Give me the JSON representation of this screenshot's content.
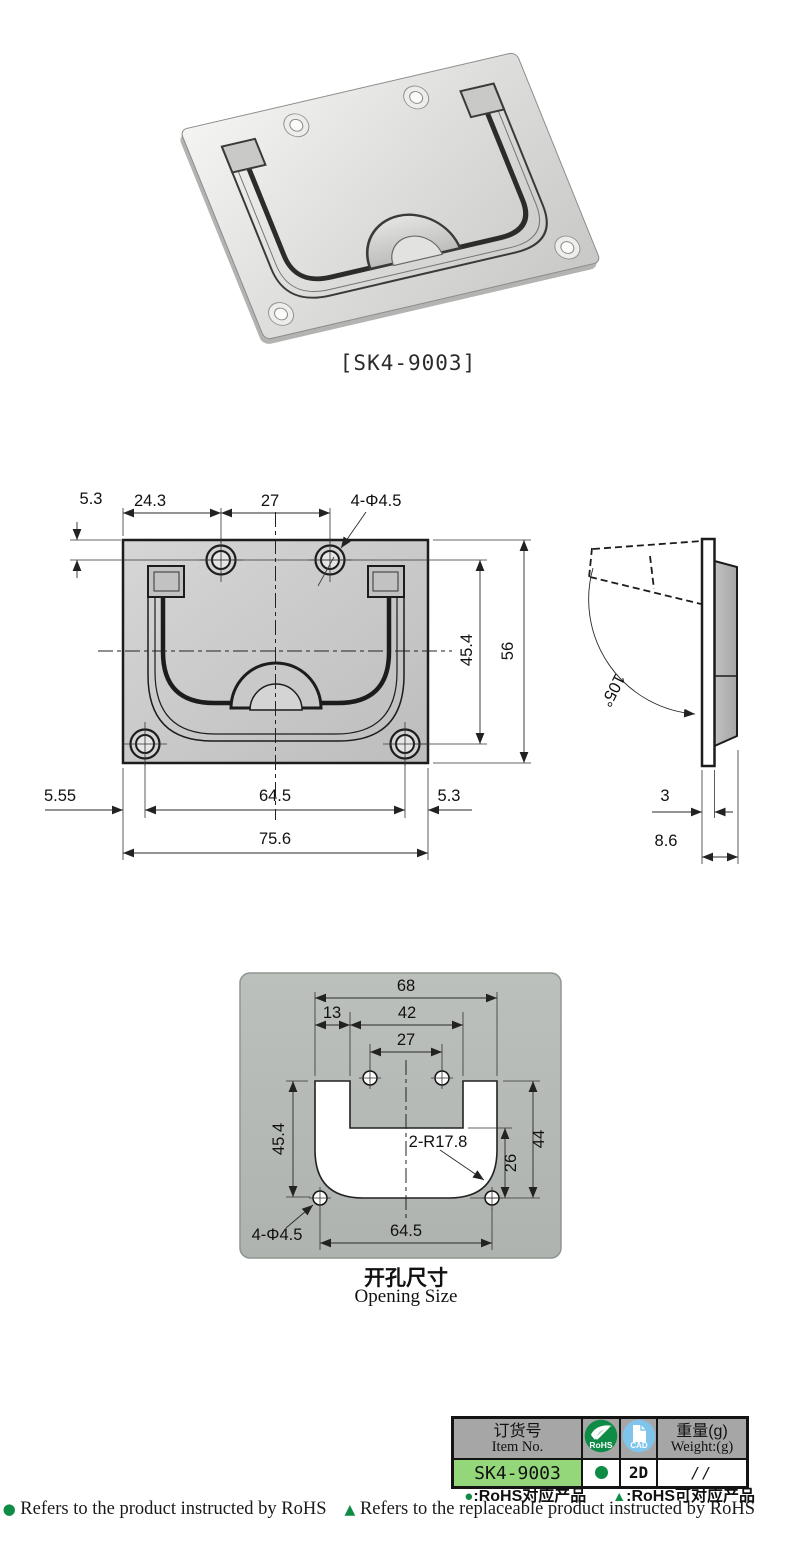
{
  "product": {
    "photo_label": "[SK4-9003]"
  },
  "front_view": {
    "dims": {
      "top_offset": "5.3",
      "left_span": "24.3",
      "hole_span": "27",
      "holes_label": "4-Φ4.5",
      "recess_height": "45.4",
      "height": "56",
      "bottom_left": "5.55",
      "bottom_span": "64.5",
      "bottom_right": "5.3",
      "width": "75.6"
    }
  },
  "side_view": {
    "dims": {
      "open_angle": "105°",
      "thickness": "3",
      "depth": "8.6"
    }
  },
  "opening_view": {
    "dims": {
      "width_top": "68",
      "tab_left": "13",
      "tab_width": "42",
      "hole_span_top": "27",
      "depth_left": "45.4",
      "corner_radius": "2-R17.8",
      "depth_right": "44",
      "lower_right": "26",
      "holes_label": "4-Φ4.5",
      "hole_span_bottom": "64.5"
    },
    "caption_cn": "开孔尺寸",
    "caption_en": "Opening Size"
  },
  "table": {
    "headers": {
      "item_cn": "订货号",
      "item_en": "Item No.",
      "rohs_label": "RoHS",
      "cad_label": "CAD",
      "weight_cn": "重量(g)",
      "weight_en": "Weight:(g)"
    },
    "row": {
      "item_no": "SK4-9003",
      "cad": "2D",
      "weight": "//"
    }
  },
  "footer": {
    "legend": {
      "dot_symbol": "●",
      "dot_label": ":RoHS对应产品",
      "tri_symbol": "▲",
      "tri_label": ":RoHS可对应产品"
    },
    "note": {
      "dot_symbol": "●",
      "dot_label": "Refers to the product instructed by RoHS",
      "tri_symbol": "▲",
      "tri_label": "Refers to the replaceable product instructed by RoHS"
    }
  },
  "colors": {
    "green": "#0e8c45",
    "row_green": "#94d67a",
    "cad_blue": "#7fc4ea",
    "header_gray": "#a6a6a6"
  }
}
